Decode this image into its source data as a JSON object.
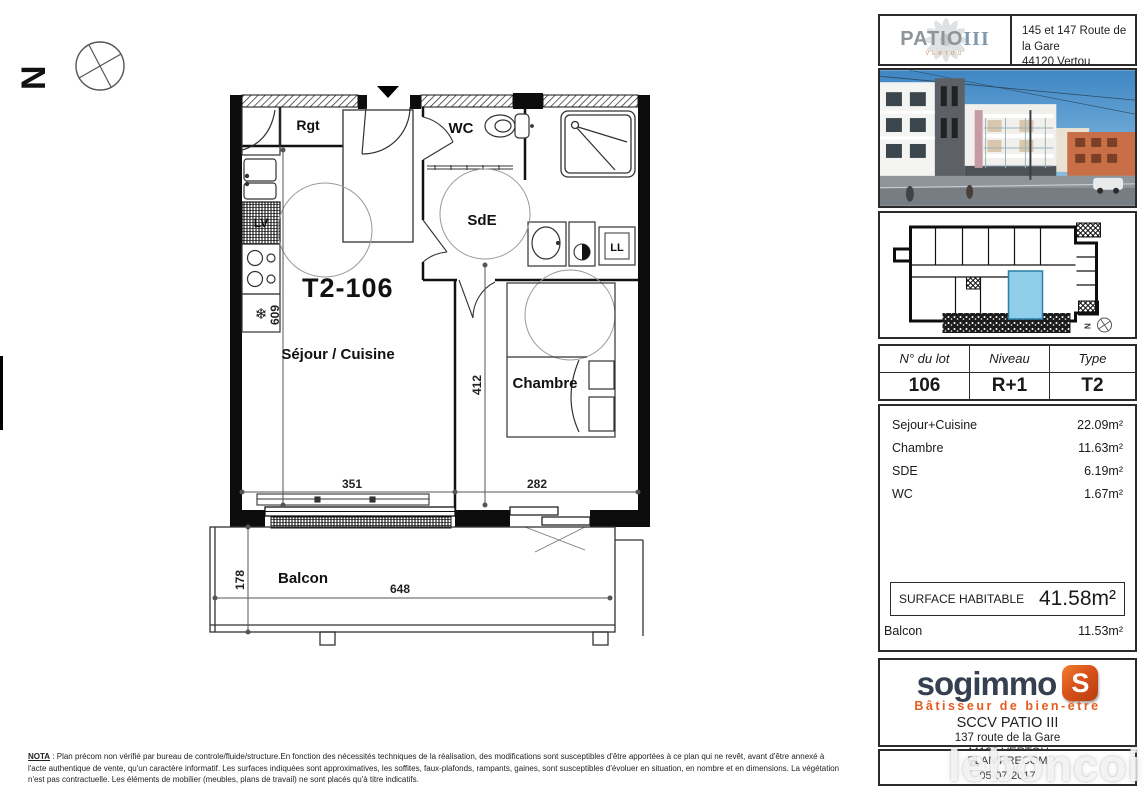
{
  "north_label": "N",
  "plan": {
    "unit_title": "T2-106",
    "rooms": {
      "sejour": "Séjour / Cuisine",
      "chambre": "Chambre",
      "wc": "WC",
      "sde": "SdE",
      "rgt": "Rgt",
      "balcon": "Balcon"
    },
    "appliances": {
      "lv": "LV",
      "ll": "LL",
      "snowflake_icon": "❄"
    },
    "dimensions": {
      "sejour_height": "609",
      "chambre_height": "412",
      "sejour_width": "351",
      "chambre_width": "282",
      "balcon_depth": "178",
      "balcon_width": "648"
    }
  },
  "sidebar": {
    "project": {
      "name": "PATIO",
      "name_suffix": "III",
      "city": "VERTOU",
      "address_line1": "145 et 147 Route de la Gare",
      "address_line2": "44120 Vertou"
    },
    "lot_table": {
      "headers": [
        "N° du lot",
        "Niveau",
        "Type"
      ],
      "values": [
        "106",
        "R+1",
        "T2"
      ]
    },
    "areas": {
      "rows": [
        {
          "label": "Sejour+Cuisine",
          "value": "22.09m²"
        },
        {
          "label": "Chambre",
          "value": "11.63m²"
        },
        {
          "label": "SDE",
          "value": "6.19m²"
        },
        {
          "label": "WC",
          "value": "1.67m²"
        }
      ],
      "surface_habitable_label": "SURFACE HABITABLE",
      "surface_habitable_value": "41.58m²",
      "balcon_label": "Balcon",
      "balcon_value": "11.53m²"
    },
    "developer": {
      "logo_text": "sogimmo",
      "logo_badge": "S",
      "tagline": "Bâtisseur de bien-être",
      "company": "SCCV PATIO III",
      "address_line1": "137 route de la Gare",
      "address_line2": "44120 VERTOU"
    },
    "plan_ref": {
      "line1": "PLAN PRECOM",
      "line2": "05-07-2017"
    }
  },
  "footer": {
    "nota_label": "NOTA",
    "line1": " : Plan précom non vérifié par bureau de controle/fluide/structure.En fonction des nécessités techniques de la réalisation, des modifications sont susceptibles d'être apportées à ce plan qui ne revêt, avant d'être annexé à",
    "line2": "l'acte authentique de vente, qu'un caractère informatif. Les surfaces indiquées sont approximatives, les soffites, faux-plafonds, rampants, gaines, sont susceptibles d'évoluer en situation, en nombre et en dimensions. La végétation",
    "line3": "n'est pas contractuelle. Les éléments de mobilier (meubles, plans de travail) ne sont placés qu'à titre indicatifs."
  },
  "watermark": "leboncoin",
  "colors": {
    "highlight_blue": "#8FCFE9",
    "accent_orange": "#E65B1E",
    "navy": "#343F4F"
  }
}
